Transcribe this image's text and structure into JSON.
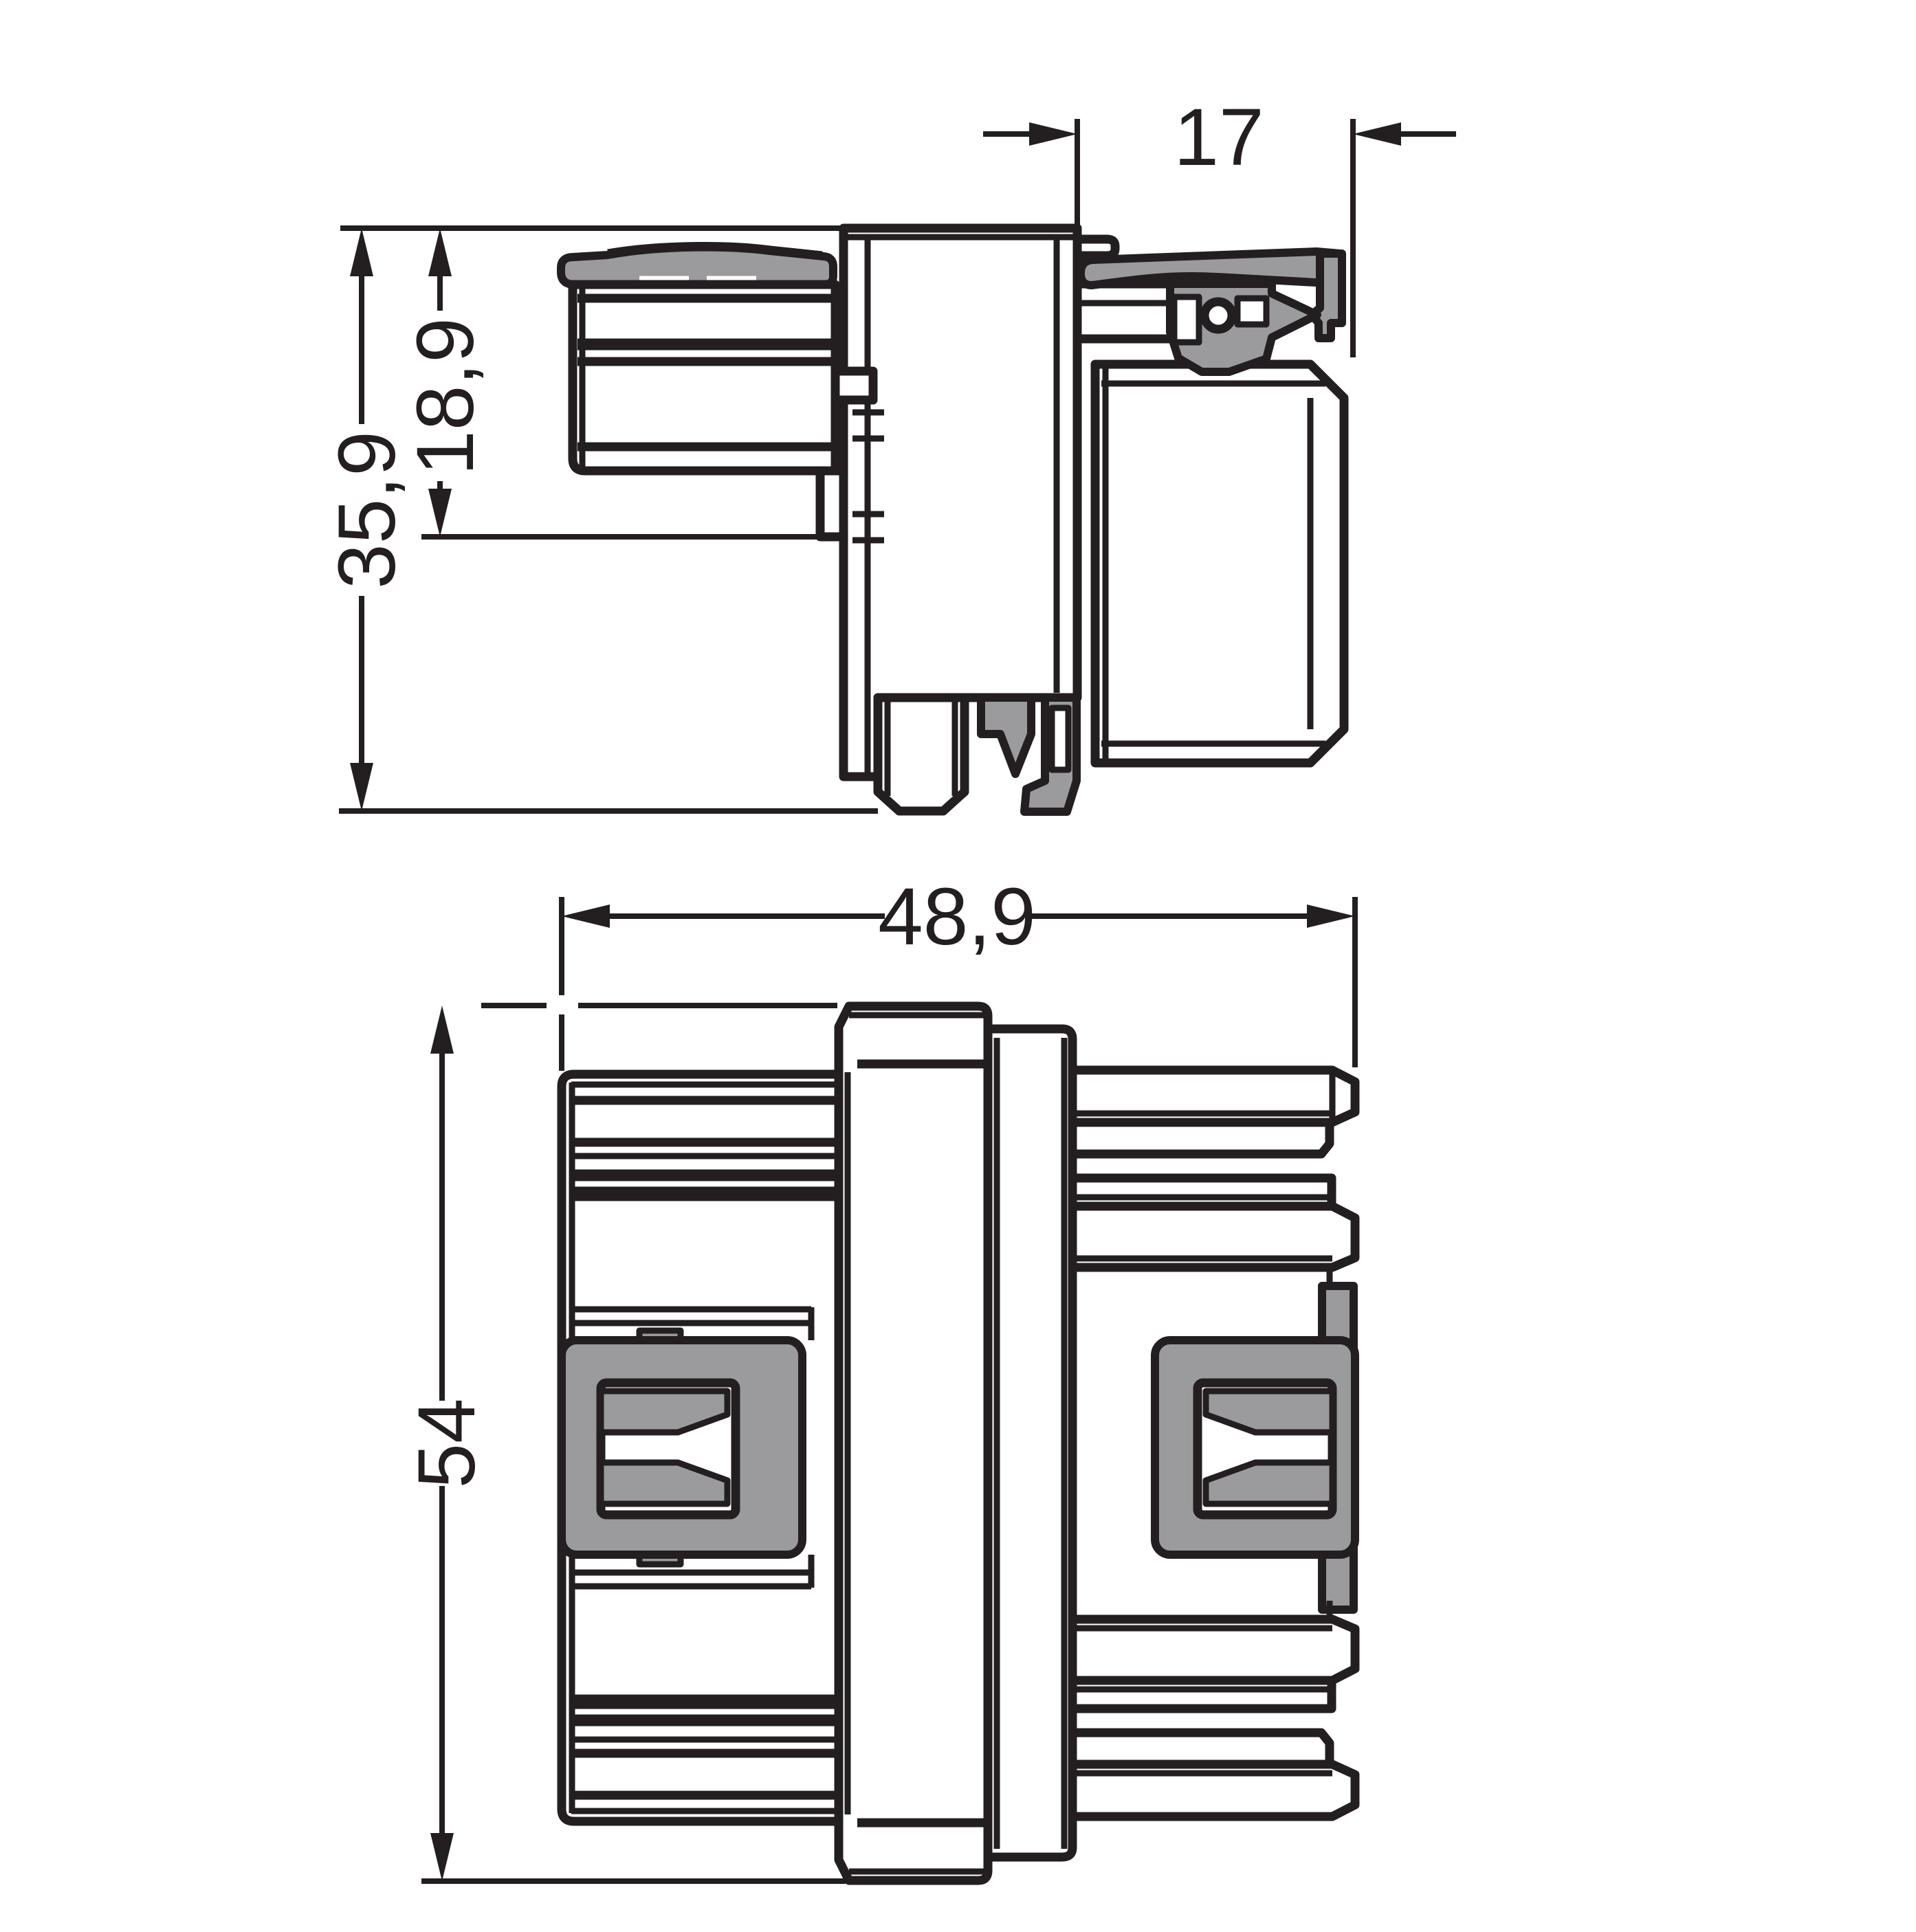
{
  "colors": {
    "line": "#231f20",
    "gray": "#9b9b9e",
    "background": "#ffffff"
  },
  "dimensions": {
    "plug_depth": "17",
    "upper_height": "18,9",
    "total_height": "35,9",
    "total_width": "48,9",
    "total_depth": "54"
  }
}
